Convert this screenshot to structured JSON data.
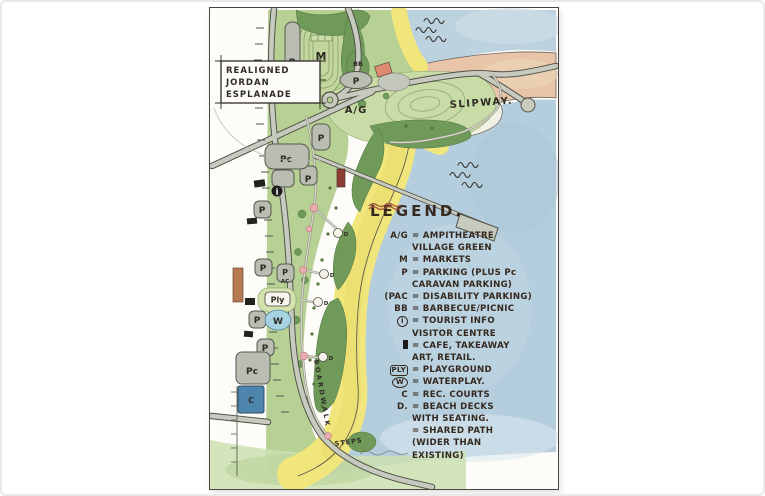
{
  "annotation_box": {
    "lines": [
      "REALIGNED",
      "JORDAN",
      "ESPLANADE"
    ]
  },
  "labels": {
    "parking": "P",
    "caravan_parking": "Pc",
    "markets": "M",
    "barbecue": "BB",
    "village_green": "A/G",
    "tourist_info": "i",
    "disability_suffix": "AC",
    "playground": "Ply",
    "waterplay": "W",
    "rec_courts": "C",
    "beach_deck": "D",
    "slipway": "SLIPWAY.",
    "boardwalk": "BOARDWALK",
    "steps": "STEPS"
  },
  "legend": {
    "title": "LEGEND.",
    "entries": [
      {
        "sym": "A/G",
        "text": "= AMPITHEATRE"
      },
      {
        "sym": "",
        "text": "VILLAGE GREEN"
      },
      {
        "sym": "M",
        "text": "= MARKETS"
      },
      {
        "sym": "P",
        "text": "= PARKING (PLUS Pc"
      },
      {
        "sym": "",
        "text": "CARAVAN PARKING)"
      },
      {
        "sym": "(PAC",
        "text": "= DISABILITY PARKING)"
      },
      {
        "sym": "BB",
        "text": "= BARBECUE/PICNIC"
      },
      {
        "sym": "i",
        "text": "= TOURIST INFO"
      },
      {
        "sym": "",
        "text": "VISITOR CENTRE"
      },
      {
        "sym": "",
        "text": "= CAFE, TAKEAWAY"
      },
      {
        "sym": "",
        "text": "ART, RETAIL."
      },
      {
        "sym": "PLY",
        "text": "= PLAYGROUND"
      },
      {
        "sym": "W",
        "text": "= WATERPLAY."
      },
      {
        "sym": "C",
        "text": "= REC. COURTS"
      },
      {
        "sym": "D.",
        "text": "= BEACH DECKS"
      },
      {
        "sym": "",
        "text": "WITH SEATING."
      },
      {
        "sym": "",
        "text": "= SHARED PATH"
      },
      {
        "sym": "",
        "text": "(WIDER THAN"
      },
      {
        "sym": "",
        "text": "EXISTING)"
      }
    ]
  },
  "colors": {
    "water": "#b5cedd",
    "water_top": "#bdd2df",
    "sand": "#f1e67c",
    "land_green": "#b7d094",
    "lawn_green": "#c9dba6",
    "tree_green": "#6f9a5a",
    "headland": "#e8c5a9",
    "road_fill": "#c7cabf",
    "road_edge": "#4f4f47",
    "parking_fill": "#b9bdb2",
    "courts_blue": "#4e85ad",
    "waterplay_blue": "#a6d2e2",
    "building_black": "#23211e",
    "kiosk_maroon": "#8d3c34",
    "deck_brown": "#b57a52",
    "node_pink": "#e8abaf",
    "ink": "#2f2b26",
    "shared_path_red": "#a5523d"
  }
}
